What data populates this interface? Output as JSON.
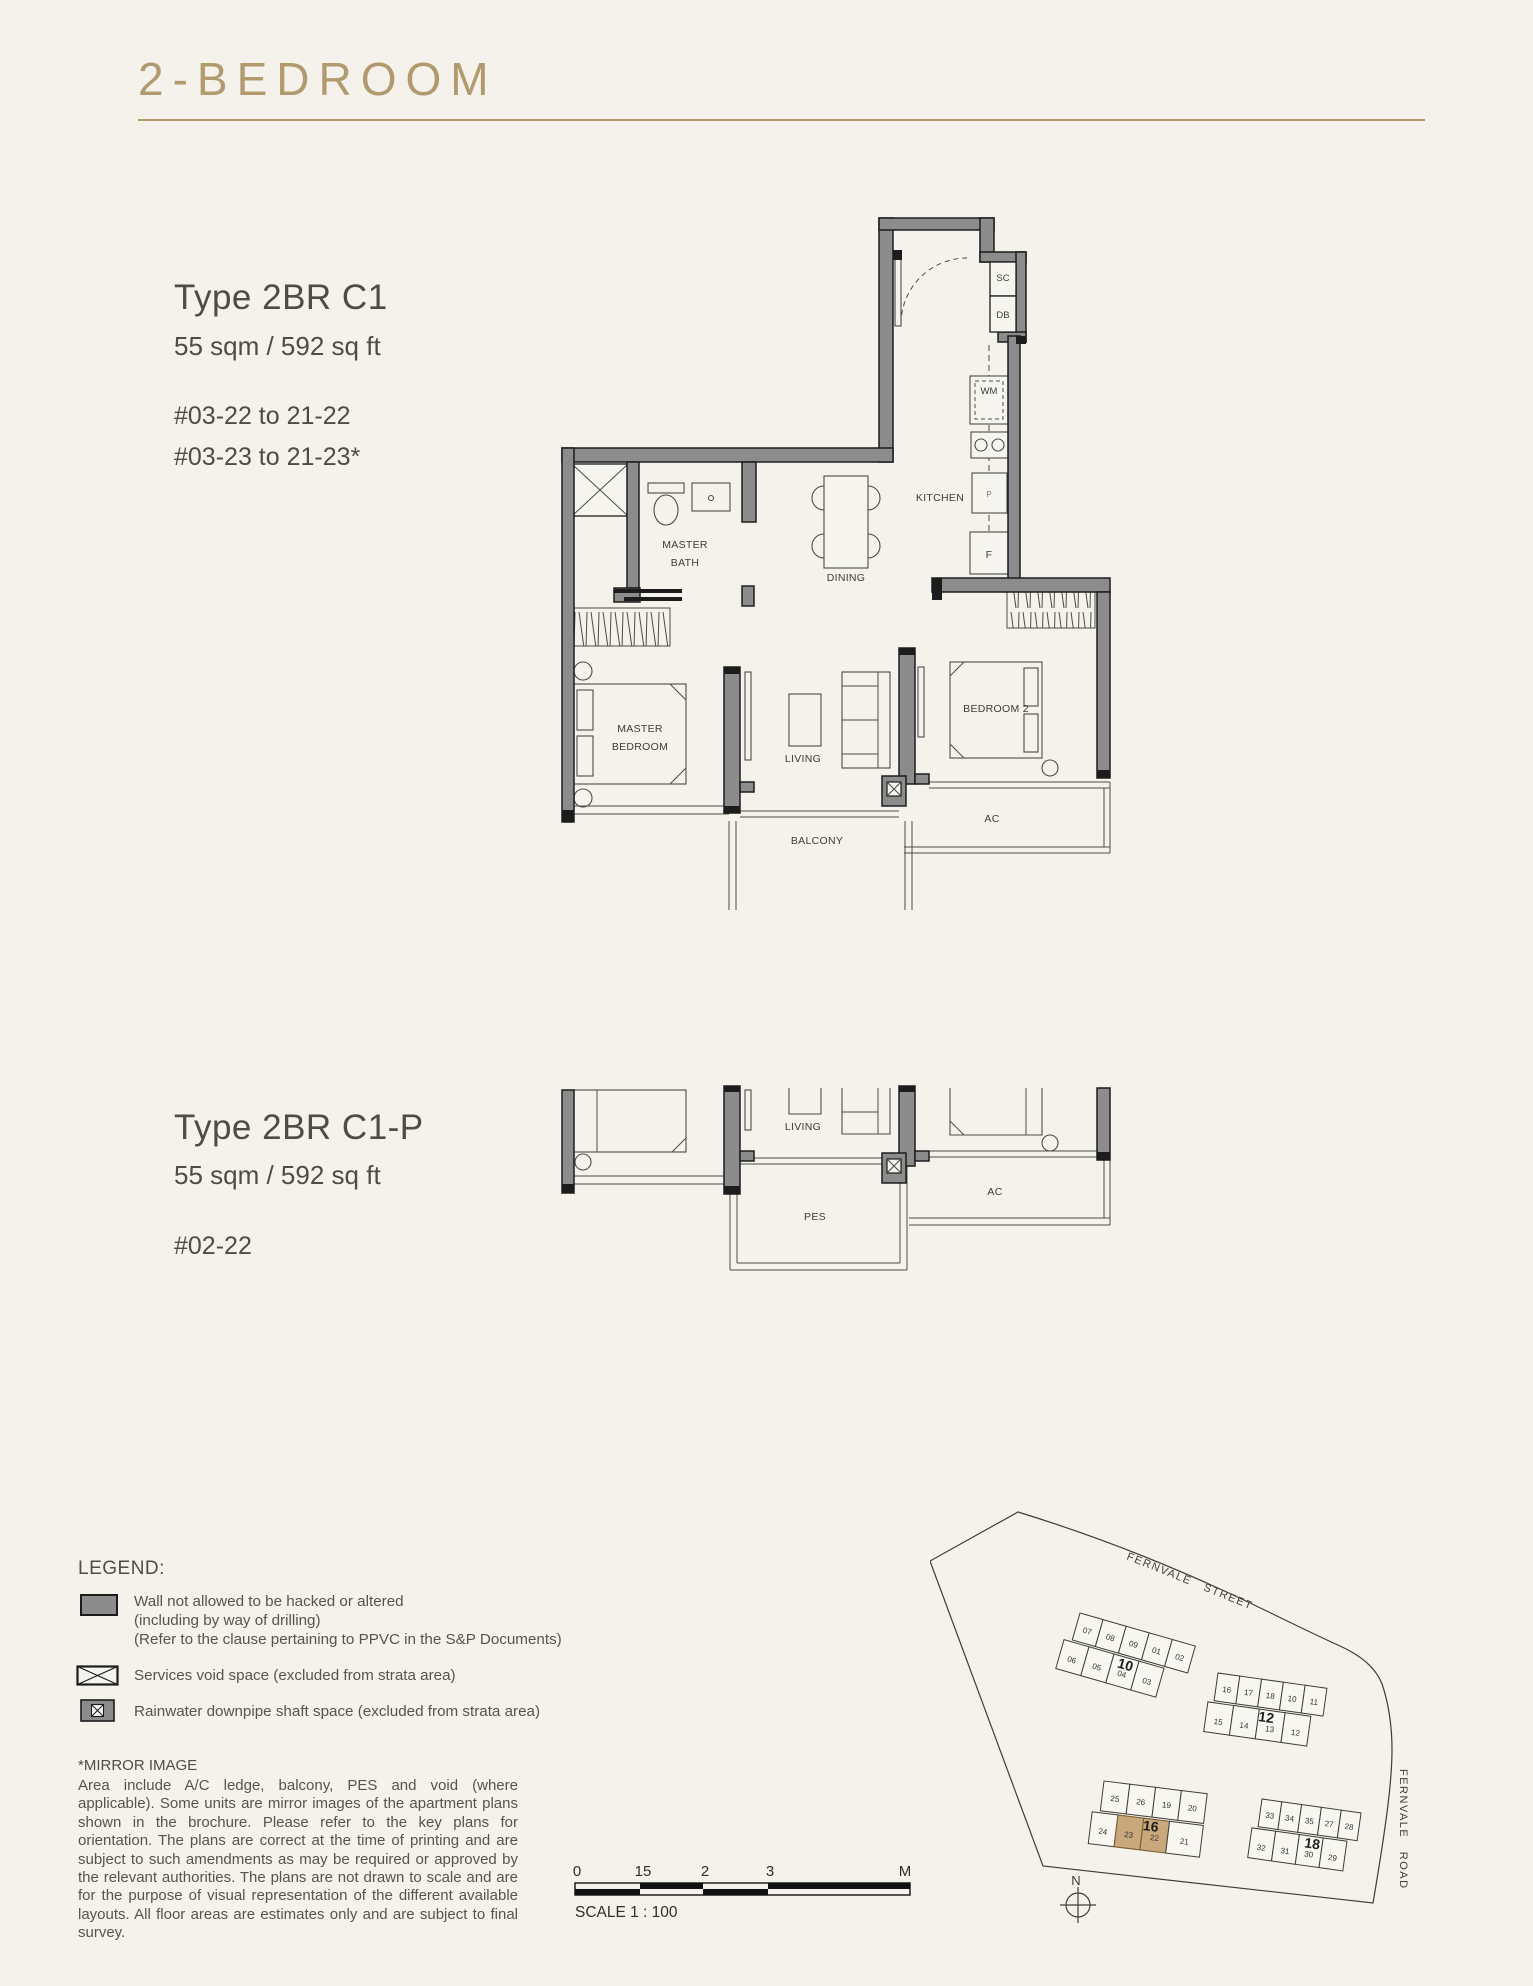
{
  "page": {
    "title": "2-BEDROOM"
  },
  "colors": {
    "accent": "#b29a6f",
    "highlight": "#c9a87c",
    "wall": "#8c8c8c"
  },
  "units": {
    "c1": {
      "type": "Type 2BR C1",
      "area": "55 sqm / 592 sq ft",
      "stack1": "#03-22 to 21-22",
      "stack2": "#03-23 to 21-23*"
    },
    "c1p": {
      "type": "Type 2BR C1-P",
      "area": "55 sqm / 592 sq ft",
      "stack1": "#02-22"
    }
  },
  "plan": {
    "sc": "SC",
    "db": "DB",
    "wm": "WM",
    "p": "P",
    "f": "F",
    "kitchen": "KITCHEN",
    "dining": "DINING",
    "master_bath_l1": "MASTER",
    "master_bath_l2": "BATH",
    "master_bed_l1": "MASTER",
    "master_bed_l2": "BEDROOM",
    "living": "LIVING",
    "bedroom2": "BEDROOM 2",
    "balcony": "BALCONY",
    "ac": "AC",
    "pes": "PES"
  },
  "legend": {
    "heading": "LEGEND:",
    "wall_l1": "Wall not allowed to be hacked or altered",
    "wall_l2": "(including by way of drilling)",
    "wall_l3": "(Refer to the clause pertaining to PPVC in the S&P Documents)",
    "void_l1": "Services void space (excluded from strata area)",
    "rain_l1": "Rainwater downpipe shaft space (excluded from strata area)"
  },
  "disclaimer": {
    "heading": "*MIRROR IMAGE",
    "body": "Area include A/C ledge, balcony, PES and void (where applicable). Some units are mirror images of the apartment plans shown in the brochure. Please refer to the key plans for orientation. The plans are correct at the time of printing and are subject to such amendments as may be required or approved by the relevant authorities. The plans are not drawn to scale and are for the purpose of visual representation of the different available layouts. All floor areas are estimates only and are subject to final survey."
  },
  "scalebar": {
    "t0": "0",
    "t1": "15",
    "t2": "2",
    "t3": "3",
    "t4": "M",
    "label": "SCALE 1 : 100"
  },
  "siteplan": {
    "street": "FERNVALE STREET",
    "road": "FERNVALE ROAD",
    "north": "N",
    "blocks": [
      {
        "name": "10",
        "top": [
          "07",
          "08",
          "09",
          "01",
          "02"
        ],
        "bottom": [
          "06",
          "05",
          "04",
          "03"
        ]
      },
      {
        "name": "12",
        "top": [
          "16",
          "17",
          "18",
          "10",
          "11"
        ],
        "bottom": [
          "15",
          "14",
          "13",
          "12"
        ]
      },
      {
        "name": "16",
        "top": [
          "25",
          "26",
          "19",
          "20"
        ],
        "bottom": [
          "24",
          "23",
          "22",
          "21"
        ]
      },
      {
        "name": "18",
        "top": [
          "33",
          "34",
          "35",
          "27",
          "28"
        ],
        "bottom": [
          "32",
          "31",
          "30",
          "29"
        ]
      }
    ]
  }
}
